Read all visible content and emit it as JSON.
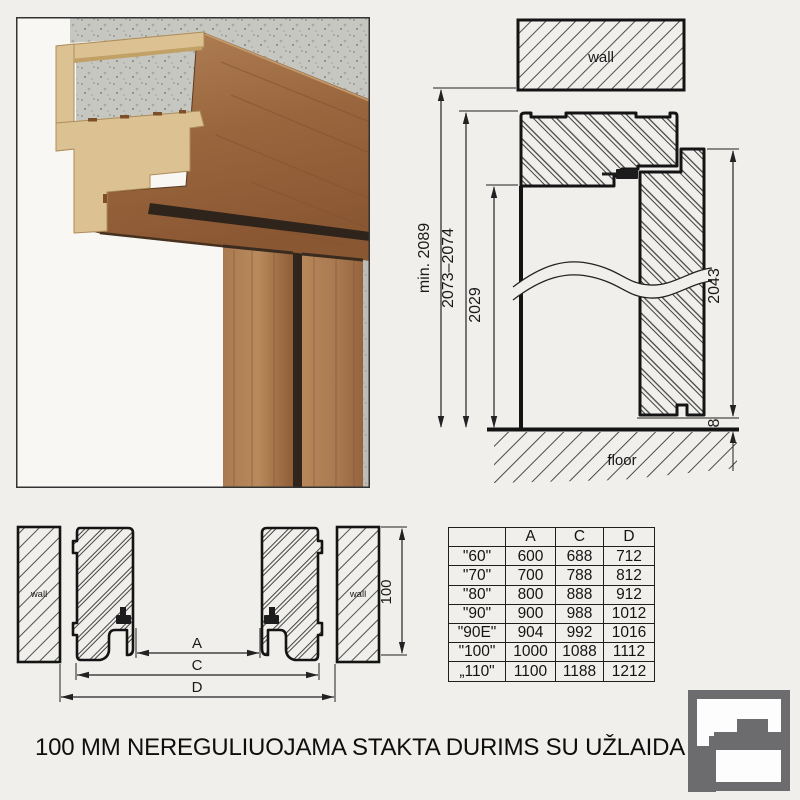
{
  "page": {
    "background": "#f0efec",
    "title": "100 MM NEREGULIUOJAMA STAKTA DURIMS SU UŽLAIDA"
  },
  "vertical_section": {
    "wall_label": "wall",
    "floor_label": "floor",
    "dims": {
      "opening_min": "min. 2089",
      "frame_outer": "2073–2074",
      "clear_opening": "2029",
      "leaf_height": "2043",
      "floor_gap": "8"
    }
  },
  "horizontal_section": {
    "left_wall_label": "wall",
    "right_wall_label": "wall",
    "dims": {
      "a": "A",
      "c": "C",
      "d": "D",
      "depth": "100"
    }
  },
  "size_table": {
    "columns": [
      "",
      "A",
      "C",
      "D"
    ],
    "rows": [
      [
        "\"60\"",
        "600",
        "688",
        "712"
      ],
      [
        "\"70\"",
        "700",
        "788",
        "812"
      ],
      [
        "\"80\"",
        "800",
        "888",
        "912"
      ],
      [
        "\"90\"",
        "900",
        "988",
        "1012"
      ],
      [
        "\"90E\"",
        "904",
        "992",
        "1016"
      ],
      [
        "\"100\"",
        "1000",
        "1088",
        "1112"
      ],
      [
        "„110\"",
        "1100",
        "1188",
        "1212"
      ]
    ]
  },
  "logo": {
    "color": "#6c6c6e"
  },
  "colors": {
    "line": "#1c1c1c",
    "hatch": "#4c4c4c",
    "wood_dark": "#7e4e2e",
    "wood_light": "#b07e52",
    "mdf": "#dcc293",
    "concrete": "#c7c7c2"
  }
}
